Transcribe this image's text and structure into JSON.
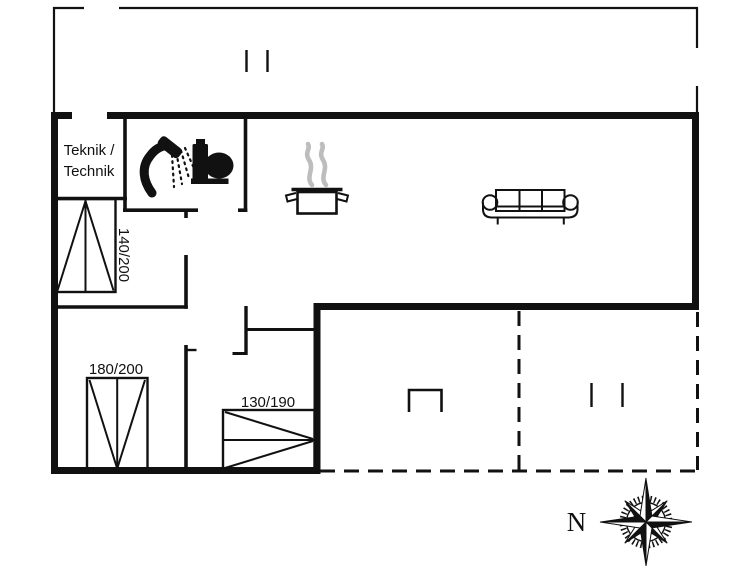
{
  "labels": {
    "technical_room_line1": "Teknik /",
    "technical_room_line2": "Technik",
    "bed_140": "140/200",
    "bed_180": "180/200",
    "bed_130": "130/190",
    "compass_north": "N"
  },
  "icons": {
    "bathroom": [
      "shower-icon",
      "toilet-icon"
    ],
    "kitchen": [
      "cooking-pot-icon",
      "steam-icon"
    ],
    "living_room": [
      "sofa-icon"
    ],
    "orientation": [
      "compass-rose-icon"
    ]
  },
  "colors": {
    "line": "#111111",
    "steam": "#bdbdbd",
    "background": "#ffffff"
  }
}
